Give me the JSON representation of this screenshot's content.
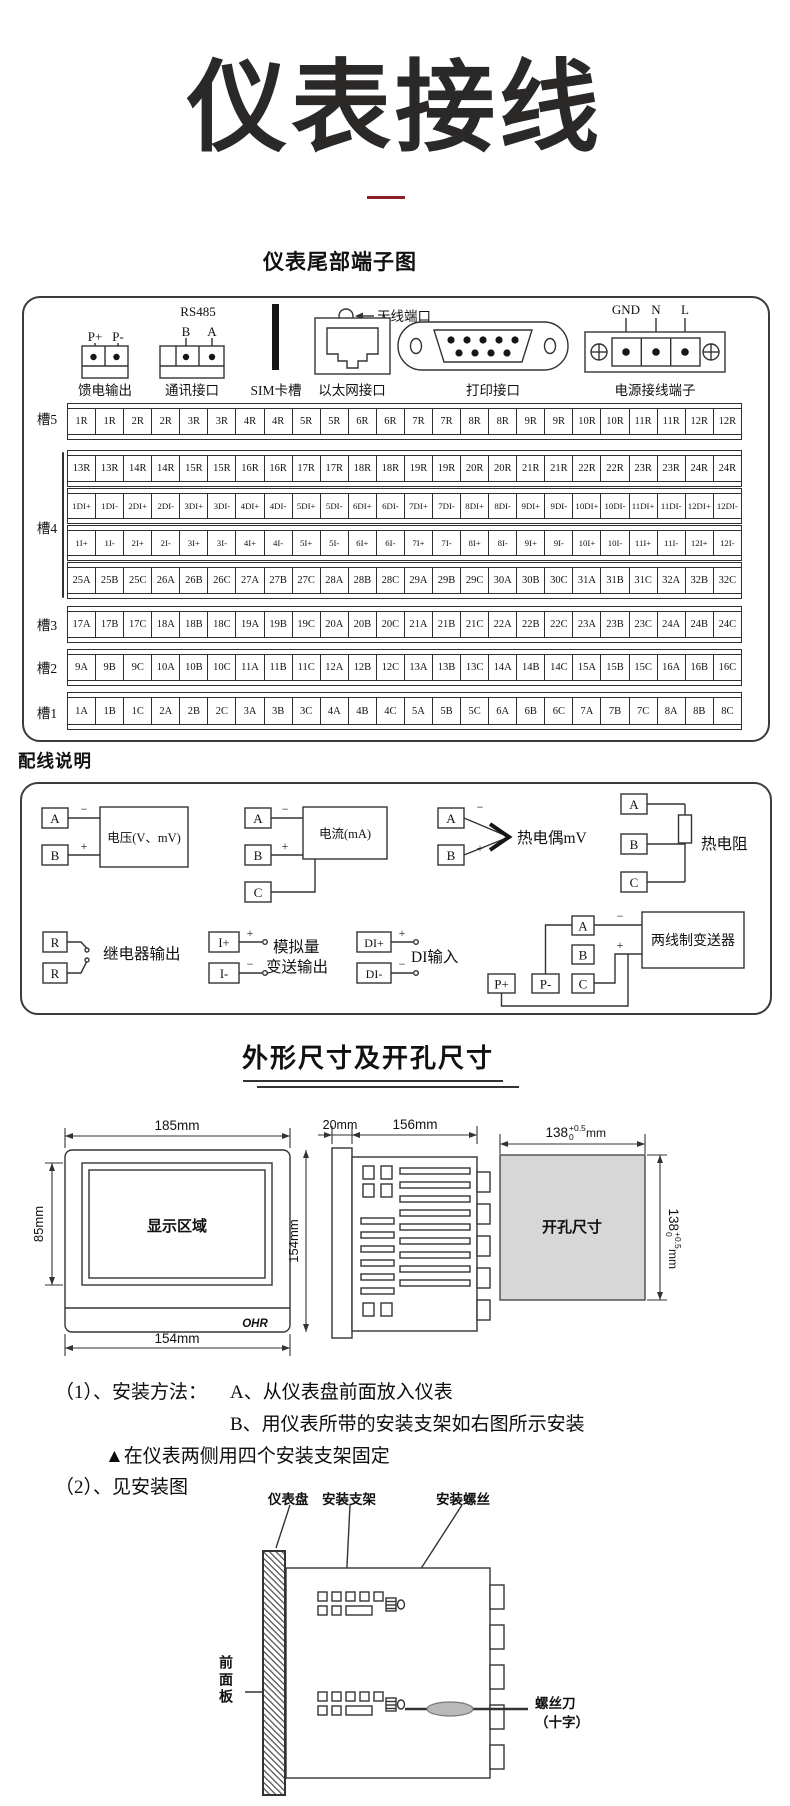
{
  "page": {
    "title": "仪表接线",
    "accent_color": "#8a1f24",
    "cutout_fill": "#d7d7d7"
  },
  "terminal_section": {
    "heading": "仪表尾部端子图",
    "connectors": {
      "feed_output": {
        "caption": "馈电输出",
        "pins": [
          "P+",
          "P-"
        ]
      },
      "comm": {
        "caption": "通讯接口",
        "protocol": "RS485",
        "pins": [
          "B",
          "A"
        ]
      },
      "sim": {
        "caption": "SIM卡槽"
      },
      "ethernet": {
        "caption": "以太网接口"
      },
      "antenna": {
        "label": "天线端口"
      },
      "printer": {
        "caption": "打印接口"
      },
      "power": {
        "caption": "电源接线端子",
        "pins": [
          "GND",
          "N",
          "L"
        ]
      }
    },
    "slots": [
      {
        "label": "槽5",
        "rows": [
          [
            "1R",
            "1R",
            "2R",
            "2R",
            "3R",
            "3R",
            "4R",
            "4R",
            "5R",
            "5R",
            "6R",
            "6R",
            "7R",
            "7R",
            "8R",
            "8R",
            "9R",
            "9R",
            "10R",
            "10R",
            "11R",
            "11R",
            "12R",
            "12R"
          ]
        ]
      },
      {
        "label": "槽4",
        "rows": [
          [
            "13R",
            "13R",
            "14R",
            "14R",
            "15R",
            "15R",
            "16R",
            "16R",
            "17R",
            "17R",
            "18R",
            "18R",
            "19R",
            "19R",
            "20R",
            "20R",
            "21R",
            "21R",
            "22R",
            "22R",
            "23R",
            "23R",
            "24R",
            "24R"
          ],
          [
            "1DI+",
            "1DI-",
            "2DI+",
            "2DI-",
            "3DI+",
            "3DI-",
            "4DI+",
            "4DI-",
            "5DI+",
            "5DI-",
            "6DI+",
            "6DI-",
            "7DI+",
            "7DI-",
            "8DI+",
            "8DI-",
            "9DI+",
            "9DI-",
            "10DI+",
            "10DI-",
            "11DI+",
            "11DI-",
            "12DI+",
            "12DI-"
          ],
          [
            "1I+",
            "1I-",
            "2I+",
            "2I-",
            "3I+",
            "3I-",
            "4I+",
            "4I-",
            "5I+",
            "5I-",
            "6I+",
            "6I-",
            "7I+",
            "7I-",
            "8I+",
            "8I-",
            "9I+",
            "9I-",
            "10I+",
            "10I-",
            "11I+",
            "11I-",
            "12I+",
            "12I-"
          ],
          [
            "25A",
            "25B",
            "25C",
            "26A",
            "26B",
            "26C",
            "27A",
            "27B",
            "27C",
            "28A",
            "28B",
            "28C",
            "29A",
            "29B",
            "29C",
            "30A",
            "30B",
            "30C",
            "31A",
            "31B",
            "31C",
            "32A",
            "32B",
            "32C"
          ]
        ]
      },
      {
        "label": "槽3",
        "rows": [
          [
            "17A",
            "17B",
            "17C",
            "18A",
            "18B",
            "18C",
            "19A",
            "19B",
            "19C",
            "20A",
            "20B",
            "20C",
            "21A",
            "21B",
            "21C",
            "22A",
            "22B",
            "22C",
            "23A",
            "23B",
            "23C",
            "24A",
            "24B",
            "24C"
          ]
        ]
      },
      {
        "label": "槽2",
        "rows": [
          [
            "9A",
            "9B",
            "9C",
            "10A",
            "10B",
            "10C",
            "11A",
            "11B",
            "11C",
            "12A",
            "12B",
            "12C",
            "13A",
            "13B",
            "13C",
            "14A",
            "14B",
            "14C",
            "15A",
            "15B",
            "15C",
            "16A",
            "16B",
            "16C"
          ]
        ]
      },
      {
        "label": "槽1",
        "rows": [
          [
            "1A",
            "1B",
            "1C",
            "2A",
            "2B",
            "2C",
            "3A",
            "3B",
            "3C",
            "4A",
            "4B",
            "4C",
            "5A",
            "5B",
            "5C",
            "6A",
            "6B",
            "6C",
            "7A",
            "7B",
            "7C",
            "8A",
            "8B",
            "8C"
          ]
        ]
      }
    ]
  },
  "wiring_section": {
    "heading": "配线说明",
    "sym": {
      "plus": "+",
      "minus": "−"
    },
    "diagrams": {
      "voltage": {
        "label": "电压(V、mV)",
        "terminals": [
          "A",
          "B"
        ]
      },
      "current": {
        "label": "电流(mA)",
        "terminals": [
          "A",
          "B",
          "C"
        ]
      },
      "thermocouple": {
        "label": "热电偶mV",
        "terminals": [
          "A",
          "B"
        ]
      },
      "rtd": {
        "label": "热电阻",
        "terminals": [
          "A",
          "B",
          "C"
        ]
      },
      "relay": {
        "label": "继电器输出",
        "terminals": [
          "R",
          "R"
        ]
      },
      "analog_out": {
        "label_line1": "模拟量",
        "label_line2": "变送输出",
        "terminals": [
          "I+",
          "I-"
        ]
      },
      "di": {
        "label": "DI输入",
        "terminals": [
          "DI+",
          "DI-"
        ]
      },
      "transmitter": {
        "label": "两线制变送器",
        "terminals": [
          "A",
          "B",
          "C"
        ],
        "power_pins": [
          "P+",
          "P-"
        ]
      }
    }
  },
  "dimension_section": {
    "heading": "外形尺寸及开孔尺寸",
    "front_view": {
      "width_dim": "185mm",
      "screen_height_dim": "85mm",
      "bottom_dim": "154mm",
      "screen_label": "显示区域",
      "brand": "OHR"
    },
    "side_view": {
      "flange_dim": "20mm",
      "depth_dim": "156mm",
      "height_dim": "154mm"
    },
    "cutout": {
      "label": "开孔尺寸",
      "dim_value": "138",
      "tol_sup": "+0.5",
      "tol_sub": "0",
      "unit": "mm"
    }
  },
  "install_section": {
    "line1_prefix": "（1）、安装方法：",
    "line1_a": "A、从仪表盘前面放入仪表",
    "line2_b": "B、用仪表所带的安装支架如右图所示安装",
    "line3": "▲在仪表两侧用四个安装支架固定",
    "line4": "（2）、见安装图",
    "diagram_labels": {
      "panel": "仪表盘",
      "bracket": "安装支架",
      "screw": "安装螺丝",
      "front_panel": "前面板",
      "screwdriver_line1": "螺丝刀",
      "screwdriver_line2": "（十字）"
    }
  }
}
